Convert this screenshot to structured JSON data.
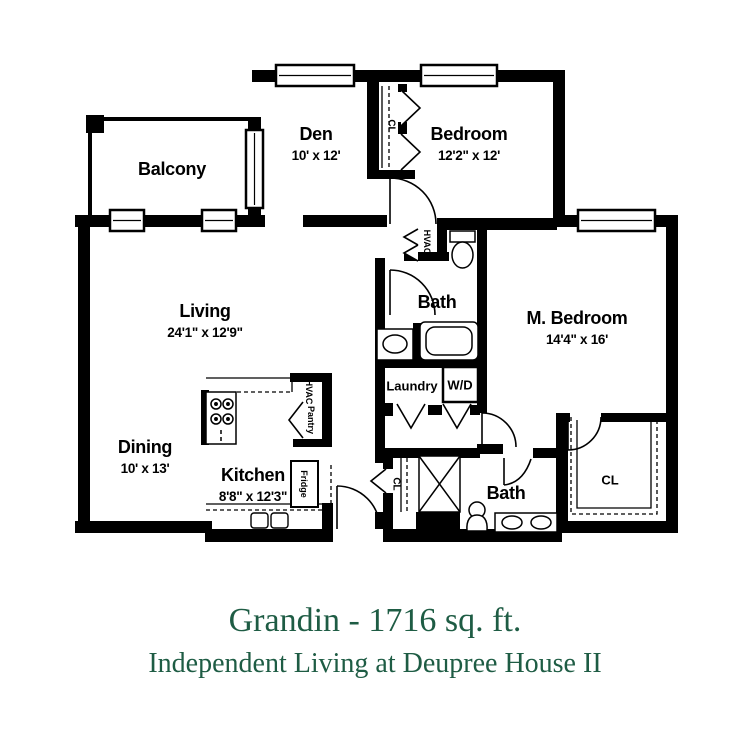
{
  "title": "Grandin - 1716 sq. ft.",
  "subtitle": "Independent Living at Deupree House II",
  "accent_color": "#1E5C44",
  "wall_color": "#000000",
  "rooms": {
    "balcony": {
      "name": "Balcony",
      "dims": ""
    },
    "den": {
      "name": "Den",
      "dims": "10' x 12'"
    },
    "bedroom": {
      "name": "Bedroom",
      "dims": "12'2\" x 12'"
    },
    "living": {
      "name": "Living",
      "dims": "24'1\" x 12'9\""
    },
    "master": {
      "name": "M. Bedroom",
      "dims": "14'4\" x 16'"
    },
    "dining": {
      "name": "Dining",
      "dims": "10' x 13'"
    },
    "kitchen": {
      "name": "Kitchen",
      "dims": "8'8\" x 12'3\""
    },
    "bath1": {
      "name": "Bath",
      "dims": ""
    },
    "bath2": {
      "name": "Bath",
      "dims": ""
    },
    "laundry": {
      "name": "Laundry",
      "dims": ""
    }
  },
  "fixtures": {
    "washer_dryer": "W/D",
    "hvac_hall": "HVAC",
    "hvac_kitchen": "HVAC",
    "pantry": "Pantry",
    "fridge": "Fridge",
    "closet_bedroom": "CL",
    "closet_hall": "CL",
    "closet_master": "CL"
  }
}
